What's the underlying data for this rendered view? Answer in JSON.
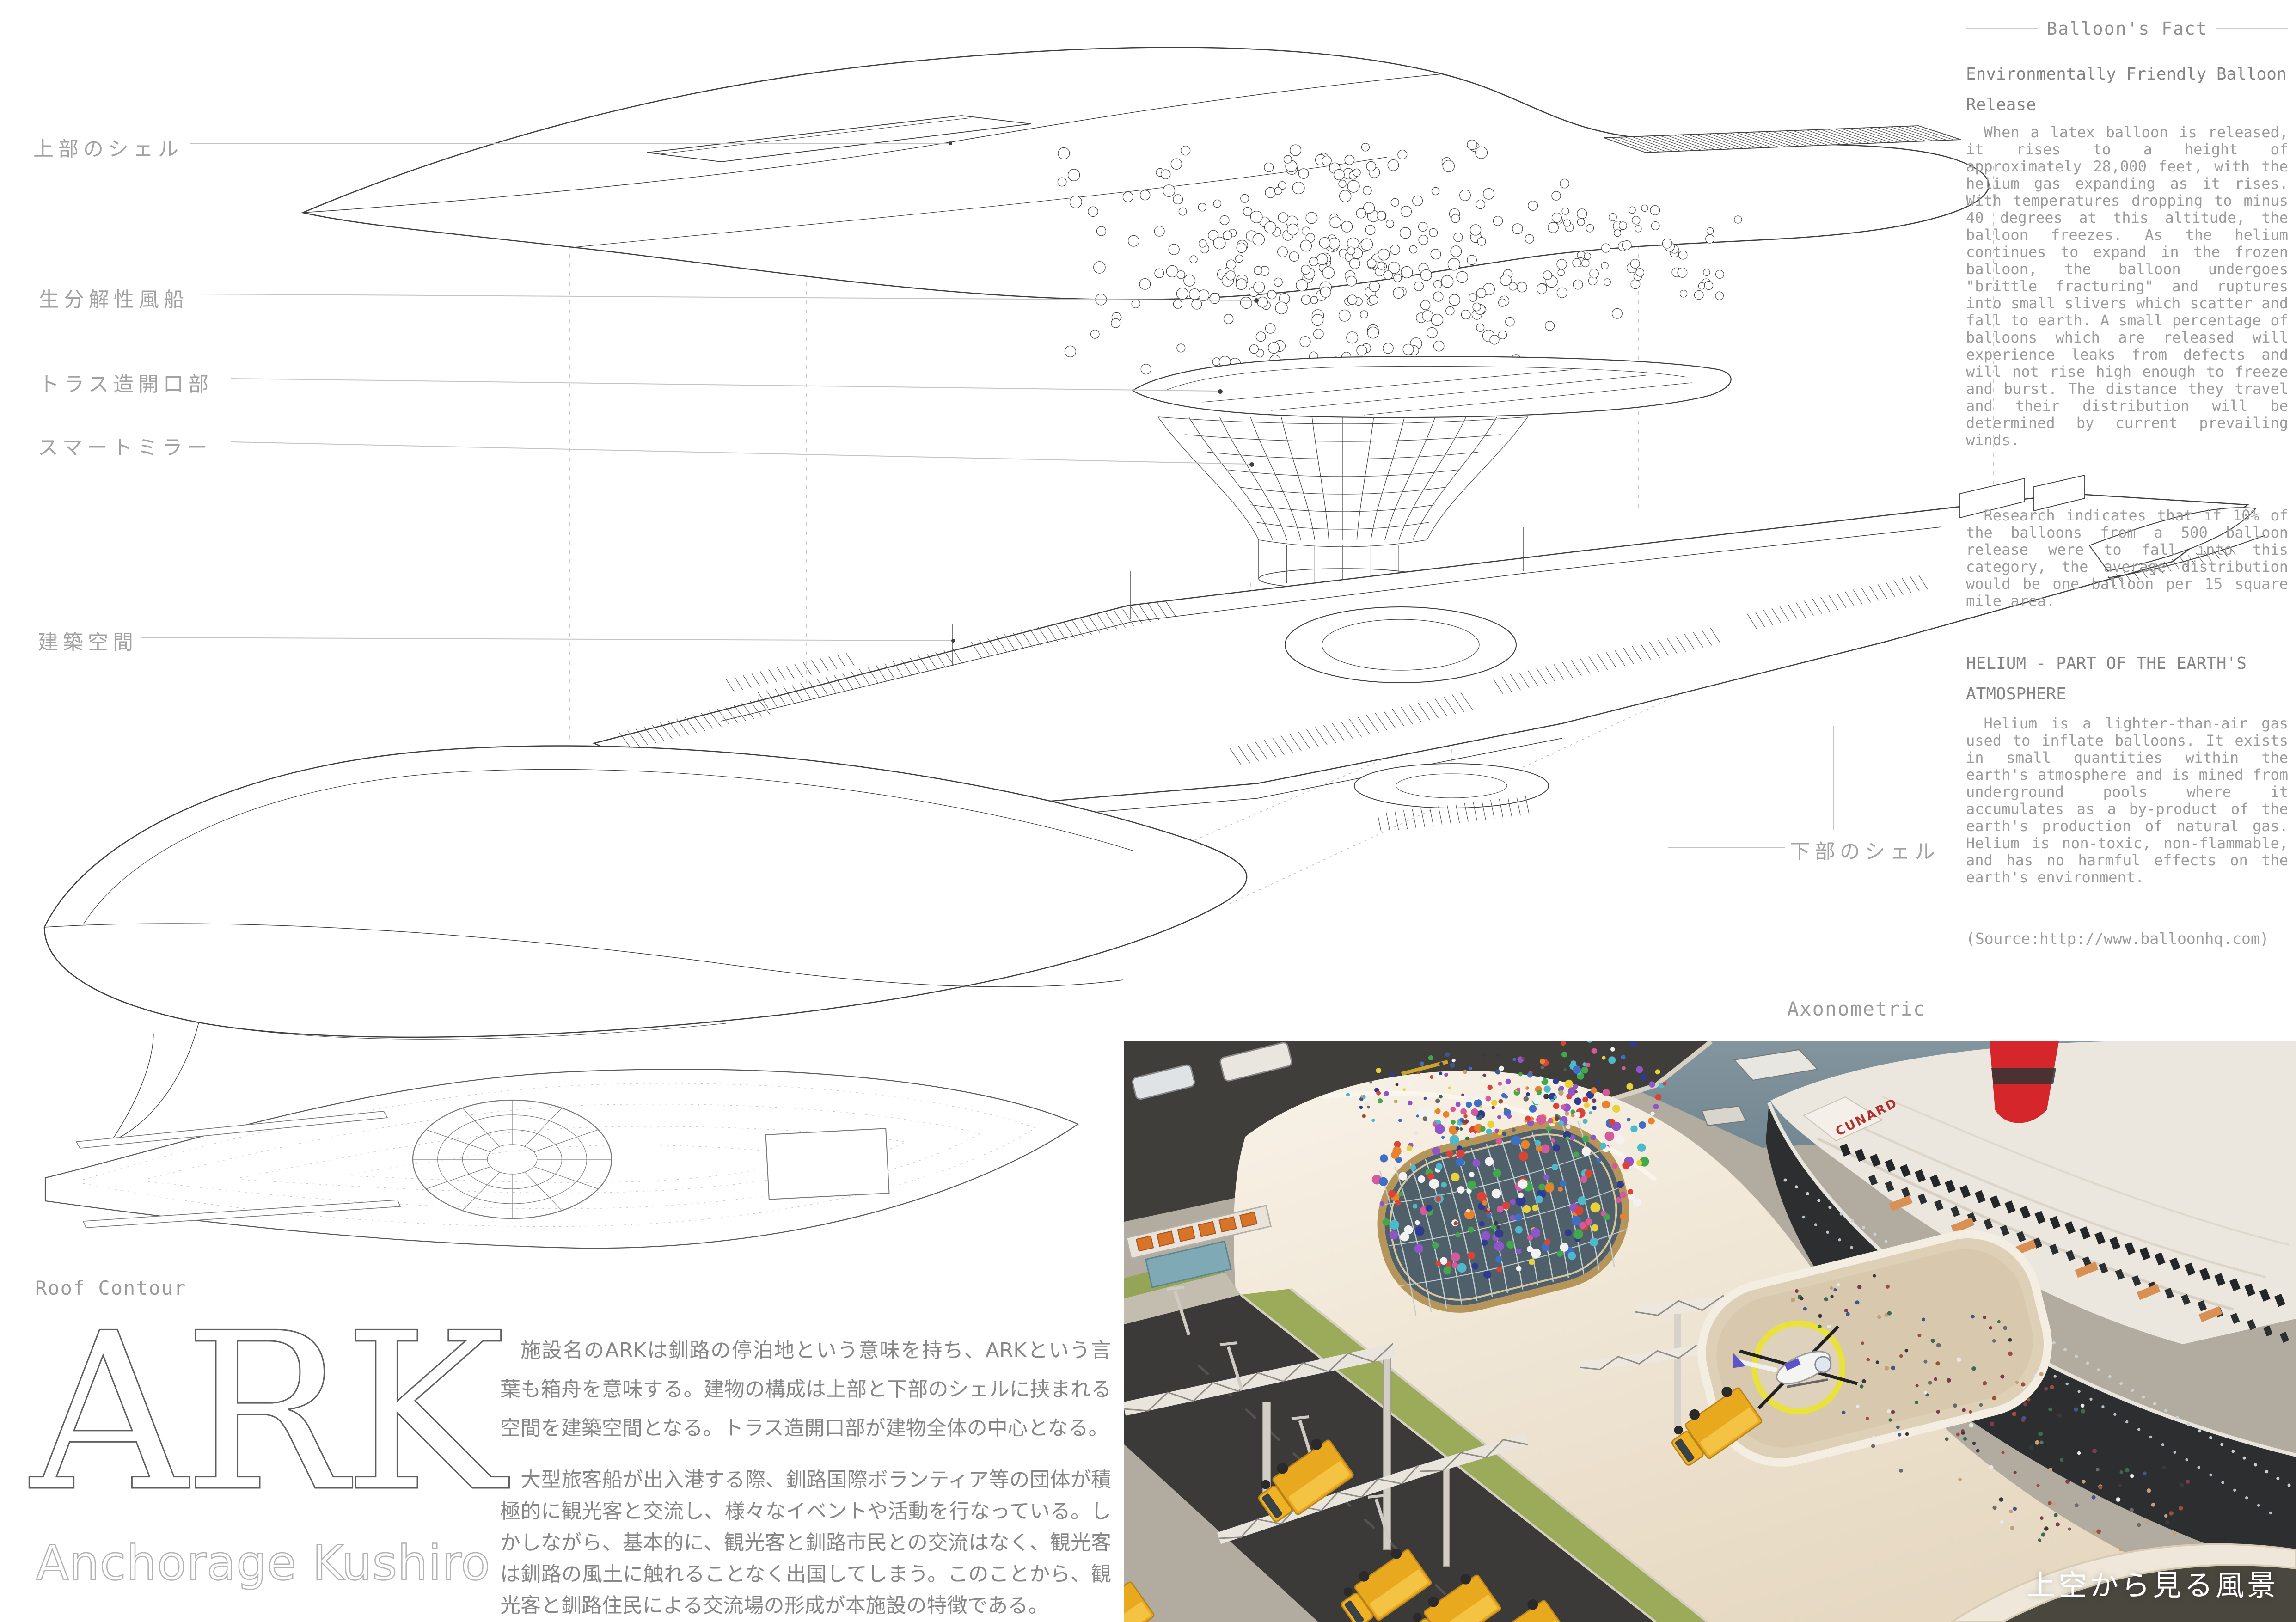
{
  "poster": {
    "axon_caption": "Axonometric",
    "roof_caption": "Roof Contour",
    "title": "ARK",
    "subtitle": "Anchorage Kushiro"
  },
  "diagram_labels": {
    "upper_shell": "上部のシェル",
    "balloon": "生分解性風船",
    "truss_opening": "トラス造開口部",
    "smart_mirror": "スマートミラー",
    "arch_space": "建築空間",
    "lower_shell": "下部のシェル"
  },
  "sidebar": {
    "header": "Balloon's Fact",
    "section1_title": "Environmentally Friendly Balloon Release",
    "section1_para1": "When a latex balloon is released, it rises to a height of approximately 28,000 feet, with the helium gas expanding as it rises. With temperatures dropping to minus 40 degrees at this altitude, the balloon freezes. As the helium continues to expand in the frozen balloon, the balloon undergoes \"brittle fracturing\" and ruptures into small slivers which scatter and fall to earth. A small percentage of balloons which are released will experience leaks from defects and will not rise high enough to freeze and burst. The distance they travel and their distribution will be determined by current prevailing winds.",
    "section1_para2": "Research indicates that if 10% of the balloons from a 500 balloon release were to fall into this category, the average distribution would be one balloon per 15 square mile area.",
    "section2_title": "HELIUM - PART OF THE EARTH'S ATMOSPHERE",
    "section2_para1": "Helium is a lighter-than-air gas used to inflate balloons. It exists in small quantities within the earth's atmosphere and is mined from underground pools where it accumulates as a by-product of the earth's production of natural gas. Helium is non-toxic, non-flammable, and has no harmful effects on the earth's environment.",
    "source": "(Source:http://www.balloonhq.com)"
  },
  "description": {
    "para1": "施設名のARKは釧路の停泊地という意味を持ち、ARKという言葉も箱舟を意味する。建物の構成は上部と下部のシェルに挟まれる空間を建築空間となる。トラス造開口部が建物全体の中心となる。",
    "para2": "大型旅客船が出入港する際、釧路国際ボランティア等の団体が積極的に観光客と交流し、様々なイベントや活動を行なっている。しかしながら、基本的に、観光客と釧路市民との交流はなく、観光客は釧路の風土に触れることなく出国してしまう。このことから、観光客と釧路住民による交流場の形成が本施設の特徴である。"
  },
  "render": {
    "caption": "上空から見る風景",
    "ship_name": "CUNARD",
    "colors": {
      "roof": "#f3ecdf",
      "water": "#6f8793",
      "pier": "#403e3b",
      "asphalt": "#3b3a38",
      "green": "#9cab5a",
      "truck_yellow": "#e9a91f",
      "ship_hull": "#2c2e30",
      "funnel_red": "#d4262b",
      "helipad_ring": "#e9e13c",
      "skylight_rim": "#b5955a",
      "heli_accent": "#5a55c8",
      "balloons": [
        "#d94436",
        "#3f6fc4",
        "#41a84d",
        "#e8d23a",
        "#8f56c9",
        "#e8822c",
        "#d55a9b",
        "#4fb9cc",
        "#f2f2f2",
        "#2f3b8f"
      ],
      "people": [
        "#3a3a3a",
        "#6b6b6b",
        "#9c4f3a",
        "#3d6b4f",
        "#41568c",
        "#c2a079",
        "#e8e8e8",
        "#7a3d50"
      ]
    }
  }
}
